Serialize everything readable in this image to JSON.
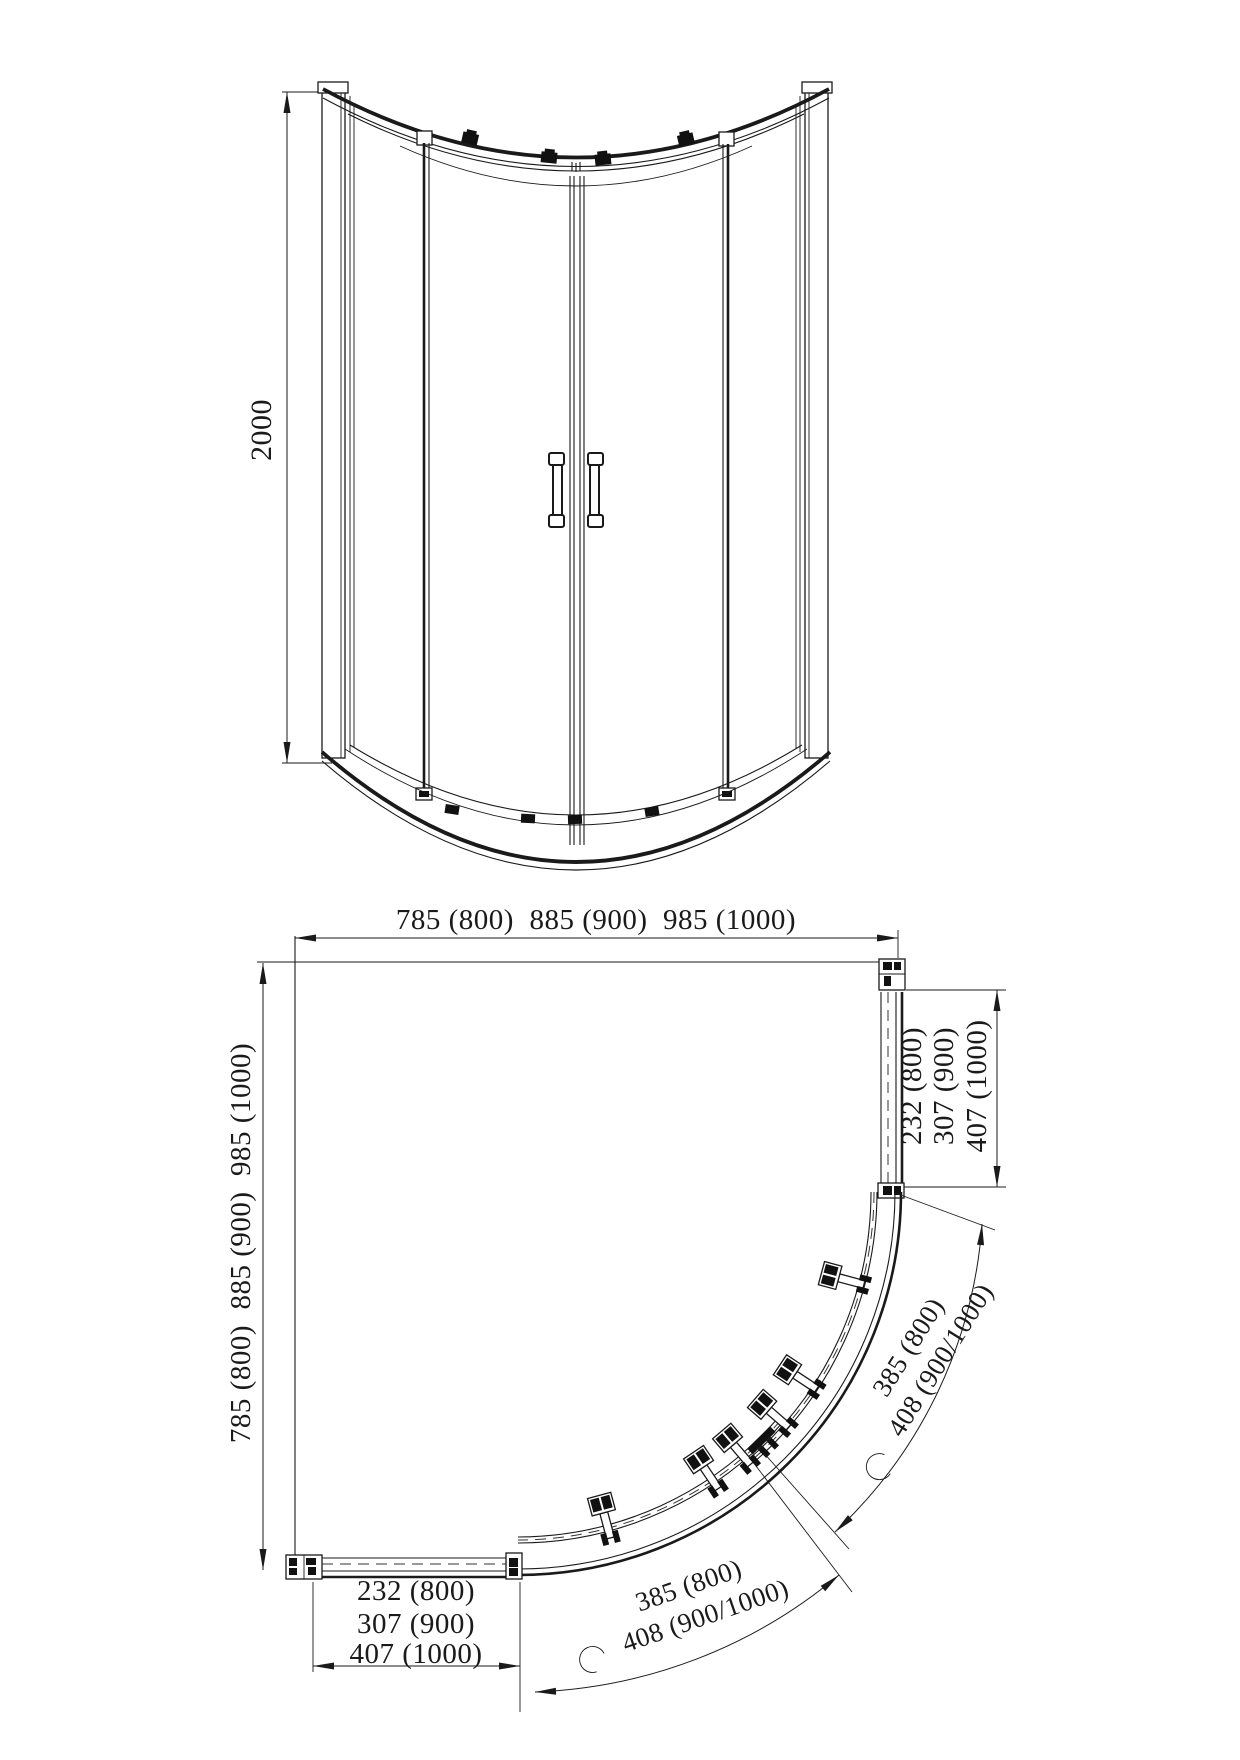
{
  "elevation": {
    "height_dim": "2000"
  },
  "plan": {
    "width_dim": "785 (800)  885 (900)  985 (1000)",
    "depth_dim": "785 (800)  885 (900)  985 (1000)",
    "right_return_dims": [
      "232 (800)",
      "307 (900)",
      "407 (1000)"
    ],
    "bottom_return_dims": [
      "232 (800)",
      "307 (900)",
      "407 (1000)"
    ],
    "right_arc_dims": [
      "385 (800)",
      "408 (900/1000)"
    ],
    "bottom_arc_dims": [
      "385 (800)",
      "408 (900/1000)"
    ]
  },
  "colors": {
    "line": "#1a1a1a",
    "background": "#ffffff"
  }
}
